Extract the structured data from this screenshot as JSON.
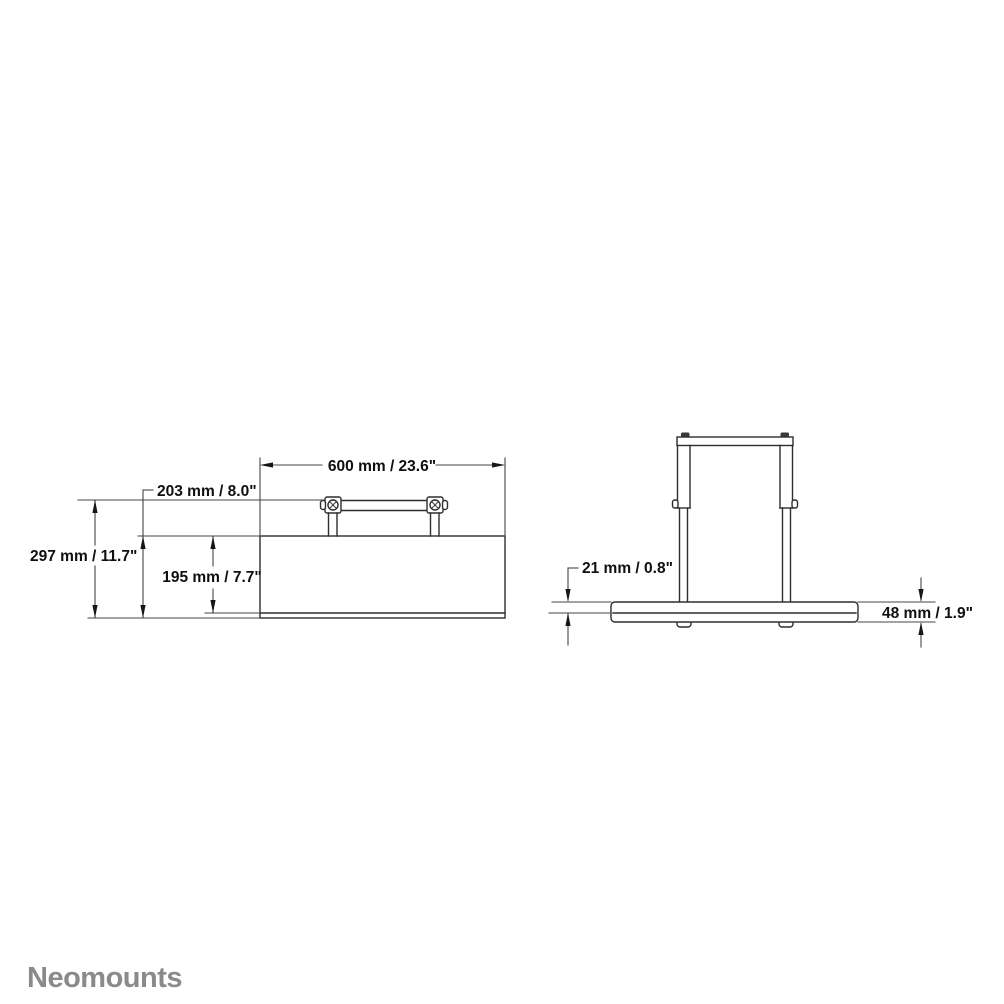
{
  "page": {
    "background": "#ffffff"
  },
  "drawing": {
    "line_color": "#2e2e2e",
    "dimension_line_color": "#454545",
    "text_color": "#0f0f0f"
  },
  "front_view": {
    "width_label": "600 mm / 23.6\"",
    "total_height_label": "297 mm / 11.7\"",
    "outer_height_label": "203 mm / 8.0\"",
    "body_height_label": "195 mm / 7.7\""
  },
  "side_view": {
    "top_thickness_label": "21 mm / 0.8\"",
    "total_thickness_label": "48 mm / 1.9\""
  },
  "footer": {
    "brand": "Neomounts",
    "brand_color": "#8a8a8a"
  }
}
